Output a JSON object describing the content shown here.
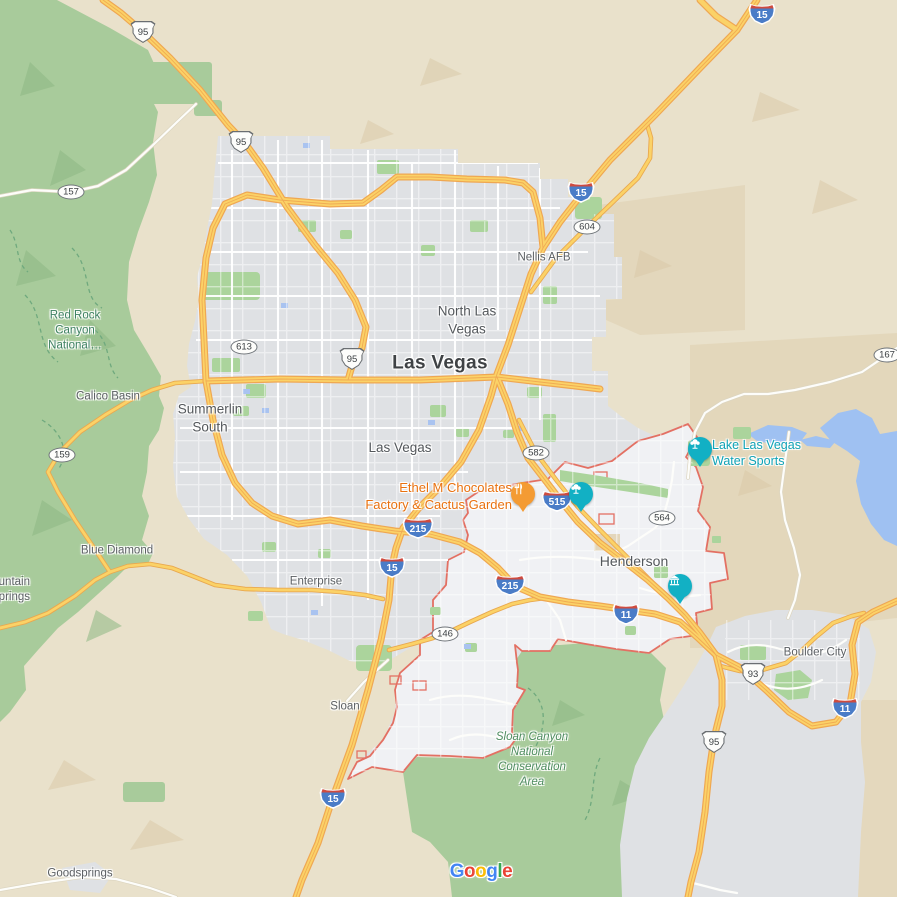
{
  "map": {
    "region": "Las Vegas valley, Nevada",
    "attribution": "Google",
    "colors": {
      "desert": "#E9E1CB",
      "desert_dark": "#DFD0B0",
      "urban": "#DFE1E4",
      "urban_light": "#F0F1F4",
      "park_green": "#ABD49C",
      "nature_green": "#A8CB9B",
      "water": "#9FC1F2",
      "freeway_fill": "#FBD267",
      "freeway_casing": "#EFA752",
      "boundary_red": "#E37063",
      "poi_teal": "#12B0C4",
      "poi_orange": "#F49B33",
      "label_green": "#3E8162",
      "label_teal": "#0FA3B7",
      "label_orange": "#E9710F"
    }
  },
  "labels": [
    {
      "id": "north-las-vegas",
      "text": "North Las\nVegas"
    },
    {
      "id": "las-vegas-major",
      "text": "Las Vegas"
    },
    {
      "id": "las-vegas-minor",
      "text": "Las Vegas"
    },
    {
      "id": "summerlin-south",
      "text": "Summerlin\nSouth"
    },
    {
      "id": "henderson",
      "text": "Henderson"
    },
    {
      "id": "nellis-afb",
      "text": "Nellis AFB"
    },
    {
      "id": "calico-basin",
      "text": "Calico Basin"
    },
    {
      "id": "blue-diamond",
      "text": "Blue Diamond"
    },
    {
      "id": "enterprise",
      "text": "Enterprise"
    },
    {
      "id": "sloan",
      "text": "Sloan"
    },
    {
      "id": "goodsprings",
      "text": "Goodsprings"
    },
    {
      "id": "boulder-city",
      "text": "Boulder City"
    },
    {
      "id": "red-rock-canyon",
      "text": "Red Rock\nCanyon\nNational…"
    },
    {
      "id": "sloan-canyon",
      "text": "Sloan Canyon\nNational\nConservation\nArea"
    },
    {
      "id": "lake-las-vegas-water-sports",
      "text": "Lake Las Vegas\nWater Sports"
    },
    {
      "id": "ethel-m-chocolates",
      "text": "Ethel M Chocolates\nFactory & Cactus Garden"
    },
    {
      "id": "mountain-springs",
      "text": "Mountain\nSprings"
    }
  ],
  "shields": [
    {
      "type": "interstate",
      "num": "15"
    },
    {
      "type": "interstate",
      "num": "15"
    },
    {
      "type": "interstate",
      "num": "15"
    },
    {
      "type": "interstate",
      "num": "15"
    },
    {
      "type": "interstate",
      "num": "215"
    },
    {
      "type": "interstate",
      "num": "215"
    },
    {
      "type": "interstate",
      "num": "515"
    },
    {
      "type": "interstate",
      "num": "11"
    },
    {
      "type": "interstate",
      "num": "11"
    },
    {
      "type": "us",
      "num": "95"
    },
    {
      "type": "us",
      "num": "95"
    },
    {
      "type": "us",
      "num": "95"
    },
    {
      "type": "us",
      "num": "95"
    },
    {
      "type": "us",
      "num": "93",
      "banner": "BUS"
    },
    {
      "type": "state",
      "num": "157"
    },
    {
      "type": "state",
      "num": "613"
    },
    {
      "type": "state",
      "num": "159"
    },
    {
      "type": "state",
      "num": "604"
    },
    {
      "type": "state",
      "num": "582"
    },
    {
      "type": "state",
      "num": "564"
    },
    {
      "type": "state",
      "num": "167"
    },
    {
      "type": "state",
      "num": "146"
    }
  ],
  "pins": [
    {
      "kind": "restaurant",
      "for": "Ethel M Chocolates Factory & Cactus Garden"
    },
    {
      "kind": "attraction",
      "for": "unnamed attraction"
    },
    {
      "kind": "attraction",
      "for": "Lake Las Vegas Water Sports"
    },
    {
      "kind": "museum",
      "for": "unnamed museum"
    }
  ],
  "logo": {
    "letters": [
      "G",
      "o",
      "o",
      "g",
      "l",
      "e"
    ]
  }
}
